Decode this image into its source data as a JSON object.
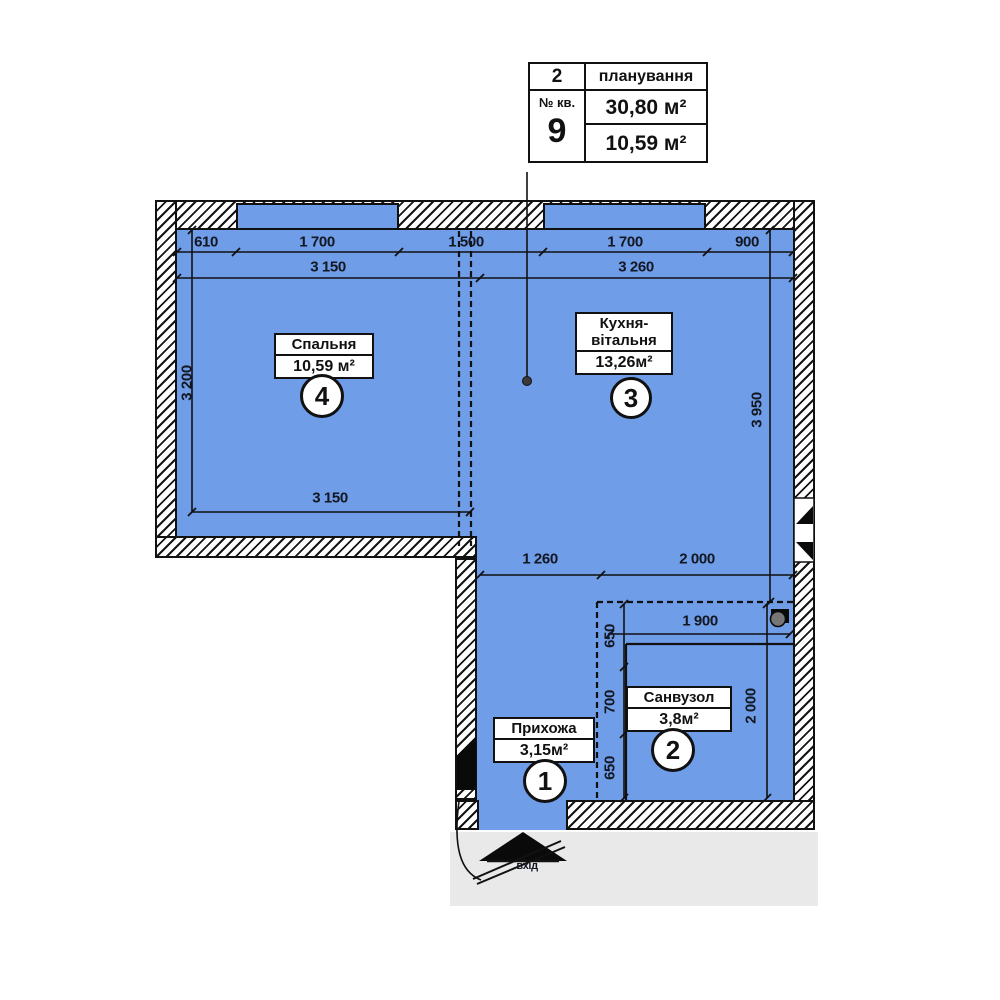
{
  "title_block": {
    "floor": "2",
    "plan_label": "планування",
    "apt_label": "№ кв.",
    "apt_number": "9",
    "total_area": "30,80 м²",
    "living_area": "10,59 м²"
  },
  "rooms": {
    "hallway": {
      "number": "1",
      "name": "Прихожа",
      "area": "3,15м²"
    },
    "bathroom": {
      "number": "2",
      "name": "Санвузол",
      "area": "3,8м²"
    },
    "kitchen": {
      "number": "3",
      "name": "Кухня-вітальня",
      "area": "13,26м²"
    },
    "bedroom": {
      "number": "4",
      "name": "Спальня",
      "area": "10,59 м²"
    }
  },
  "dims": {
    "top_segments": [
      "610",
      "1 700",
      "1 500",
      "1 700",
      "900"
    ],
    "top_totals": [
      "3 150",
      "3 260"
    ],
    "left_height": "3 200",
    "right_height": "3 950",
    "bedroom_width_bottom": "3 150",
    "lower_widths": [
      "1 260",
      "2 000"
    ],
    "bath_width": "1 900",
    "bath_left_segments": [
      "650",
      "700",
      "650"
    ],
    "bath_height": "2 000"
  },
  "entrance": {
    "label": "вхід"
  },
  "colors": {
    "room_fill": "#6f9de8",
    "line": "#111111",
    "ground_shadow": "#e9e9e9"
  }
}
